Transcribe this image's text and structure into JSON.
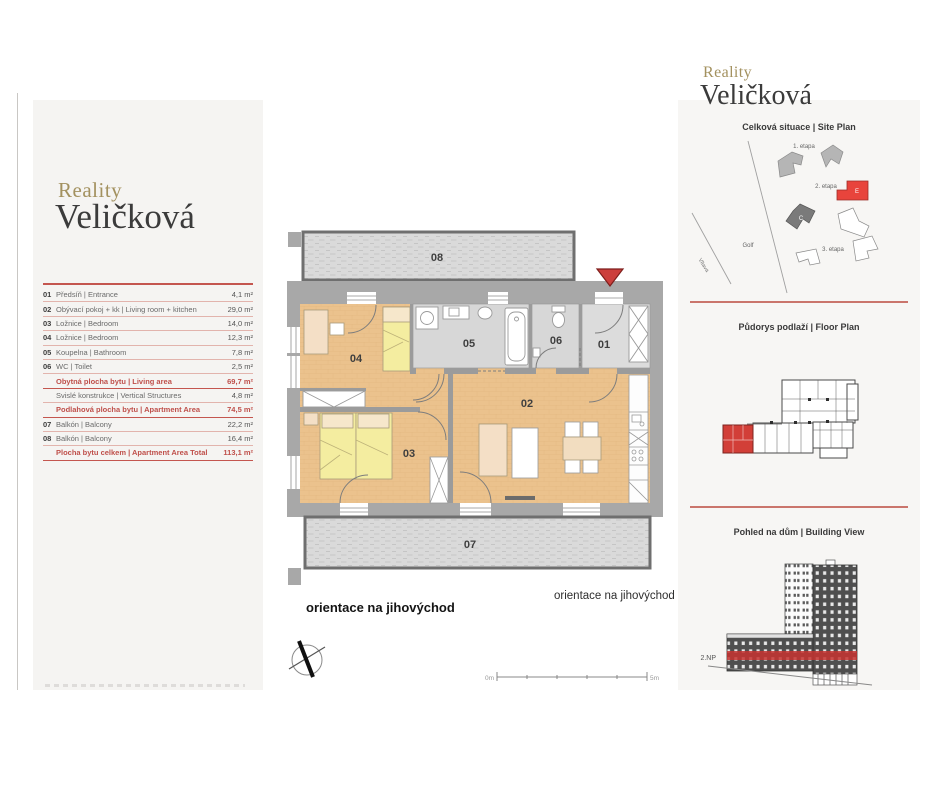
{
  "left": {
    "logo1": "Reality",
    "logo2": "Veličková",
    "rows": [
      {
        "num": "01",
        "label": "Předsíň | Entrance",
        "value": "4,1 m²"
      },
      {
        "num": "02",
        "label": "Obývací pokoj + kk | Living room + kitchen",
        "value": "29,0 m²"
      },
      {
        "num": "03",
        "label": "Ložnice | Bedroom",
        "value": "14,0 m²"
      },
      {
        "num": "04",
        "label": "Ložnice | Bedroom",
        "value": "12,3 m²"
      },
      {
        "num": "05",
        "label": "Koupelna | Bathroom",
        "value": "7,8 m²"
      },
      {
        "num": "06",
        "label": "WC | Toilet",
        "value": "2,5 m²"
      },
      {
        "num": "",
        "label": "Obytná plocha bytu | Living area",
        "value": "69,7 m²"
      },
      {
        "num": "",
        "label": "Svislé konstrukce | Vertical Structures",
        "value": "4,8 m²"
      },
      {
        "num": "",
        "label": "Podlahová plocha bytu | Apartment Area",
        "value": "74,5 m²"
      },
      {
        "num": "07",
        "label": "Balkón | Balcony",
        "value": "22,2 m²"
      },
      {
        "num": "08",
        "label": "Balkón | Balcony",
        "value": "16,4 m²"
      },
      {
        "num": "",
        "label": "Plocha bytu celkem | Apartment Area Total",
        "value": "113,1 m²"
      }
    ]
  },
  "plan": {
    "rooms": {
      "r01": "01",
      "r02": "02",
      "r03": "03",
      "r04": "04",
      "r05": "05",
      "r06": "06",
      "r07": "07",
      "r08": "08"
    },
    "orientation_bold": "orientace na jihovýchod",
    "orientation_right": "orientace na jihovýchod",
    "scale_start": "0m",
    "scale_end": "5m"
  },
  "right": {
    "logo1": "Reality",
    "logo2": "Veličková",
    "site_title": "Celková situace | Site Plan",
    "floor_title": "Půdorys podlaží | Floor Plan",
    "view_title": "Pohled na dům | Building View",
    "site": {
      "etapa1": "1. etapa",
      "etapa2": "2. etapa",
      "etapa3": "3. etapa",
      "golf": "Golf",
      "river": "Vltava",
      "building_e": "E",
      "building_c": "C"
    },
    "floor_label": "2.NP"
  },
  "colors": {
    "accent_red": "#c0504d",
    "rule_salmon": "#c4564f",
    "brand_gold": "#a3915f",
    "site_red": "#e8443c",
    "highlight_red": "#d23f38",
    "wall_gray": "#a8a8a8",
    "wood_floor": "#ebc28d"
  }
}
